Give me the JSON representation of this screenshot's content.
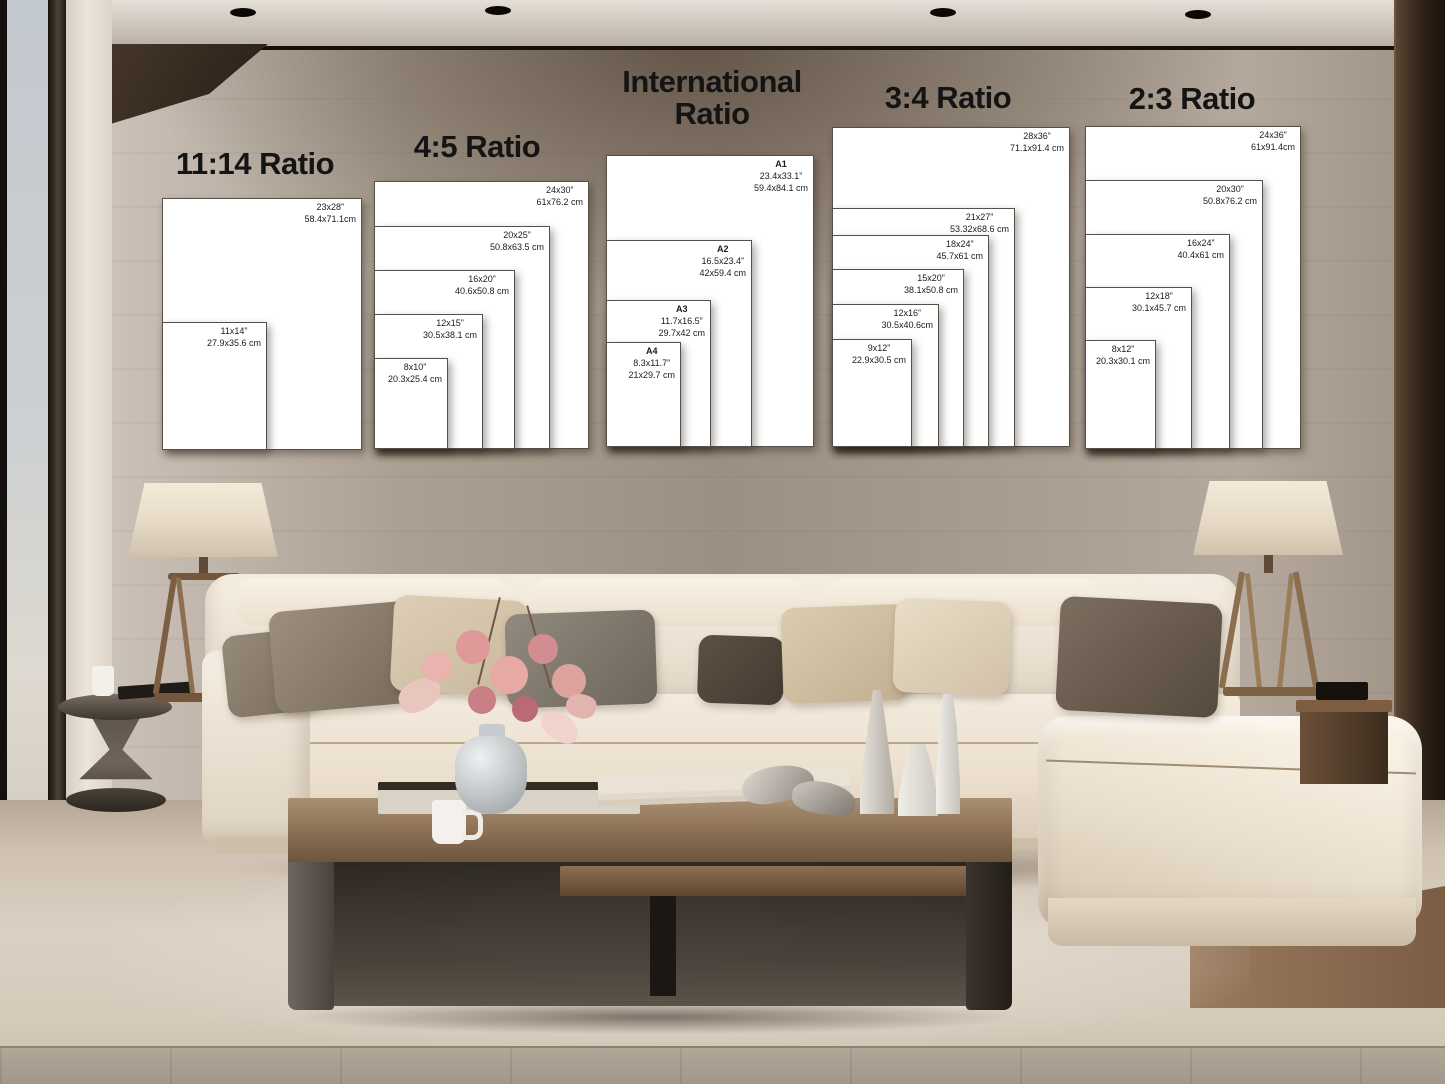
{
  "colors": {
    "heading_text": "#141414",
    "poster_background": "#ffffff",
    "poster_border": "#55504a",
    "wall_taupe": "#9c9082",
    "sofa_cream": "#f3ebdd"
  },
  "size_chart": {
    "groups": [
      {
        "title": "11:14 Ratio",
        "sizes": [
          {
            "name": "",
            "inches": "23x28”",
            "cm": "58.4x71.1cm"
          },
          {
            "name": "",
            "inches": "11x14”",
            "cm": "27.9x35.6 cm"
          }
        ]
      },
      {
        "title": "4:5 Ratio",
        "sizes": [
          {
            "name": "",
            "inches": "24x30”",
            "cm": "61x76.2 cm"
          },
          {
            "name": "",
            "inches": "20x25”",
            "cm": "50.8x63.5 cm"
          },
          {
            "name": "",
            "inches": "16x20”",
            "cm": "40.6x50.8 cm"
          },
          {
            "name": "",
            "inches": "12x15”",
            "cm": "30.5x38.1 cm"
          },
          {
            "name": "",
            "inches": "8x10”",
            "cm": "20.3x25.4 cm"
          }
        ]
      },
      {
        "title": "International Ratio",
        "sizes": [
          {
            "name": "A1",
            "inches": "23.4x33.1”",
            "cm": "59.4x84.1 cm"
          },
          {
            "name": "A2",
            "inches": "16.5x23.4”",
            "cm": "42x59.4 cm"
          },
          {
            "name": "A3",
            "inches": "11.7x16.5”",
            "cm": "29.7x42 cm"
          },
          {
            "name": "A4",
            "inches": "8.3x11.7”",
            "cm": "21x29.7 cm"
          }
        ]
      },
      {
        "title": "3:4 Ratio",
        "sizes": [
          {
            "name": "",
            "inches": "28x36”",
            "cm": "71.1x91.4 cm"
          },
          {
            "name": "",
            "inches": "21x27”",
            "cm": "53.32x68.6 cm"
          },
          {
            "name": "",
            "inches": "18x24”",
            "cm": "45.7x61 cm"
          },
          {
            "name": "",
            "inches": "15x20”",
            "cm": "38.1x50.8 cm"
          },
          {
            "name": "",
            "inches": "12x16”",
            "cm": "30.5x40.6cm"
          },
          {
            "name": "",
            "inches": "9x12”",
            "cm": "22.9x30.5 cm"
          }
        ]
      },
      {
        "title": "2:3 Ratio",
        "sizes": [
          {
            "name": "",
            "inches": "24x36”",
            "cm": "61x91.4cm"
          },
          {
            "name": "",
            "inches": "20x30”",
            "cm": "50.8x76.2 cm"
          },
          {
            "name": "",
            "inches": "16x24”",
            "cm": "40.4x61 cm"
          },
          {
            "name": "",
            "inches": "12x18”",
            "cm": "30.1x45.7 cm"
          },
          {
            "name": "",
            "inches": "8x12”",
            "cm": "20.3x30.1 cm"
          }
        ]
      }
    ]
  }
}
